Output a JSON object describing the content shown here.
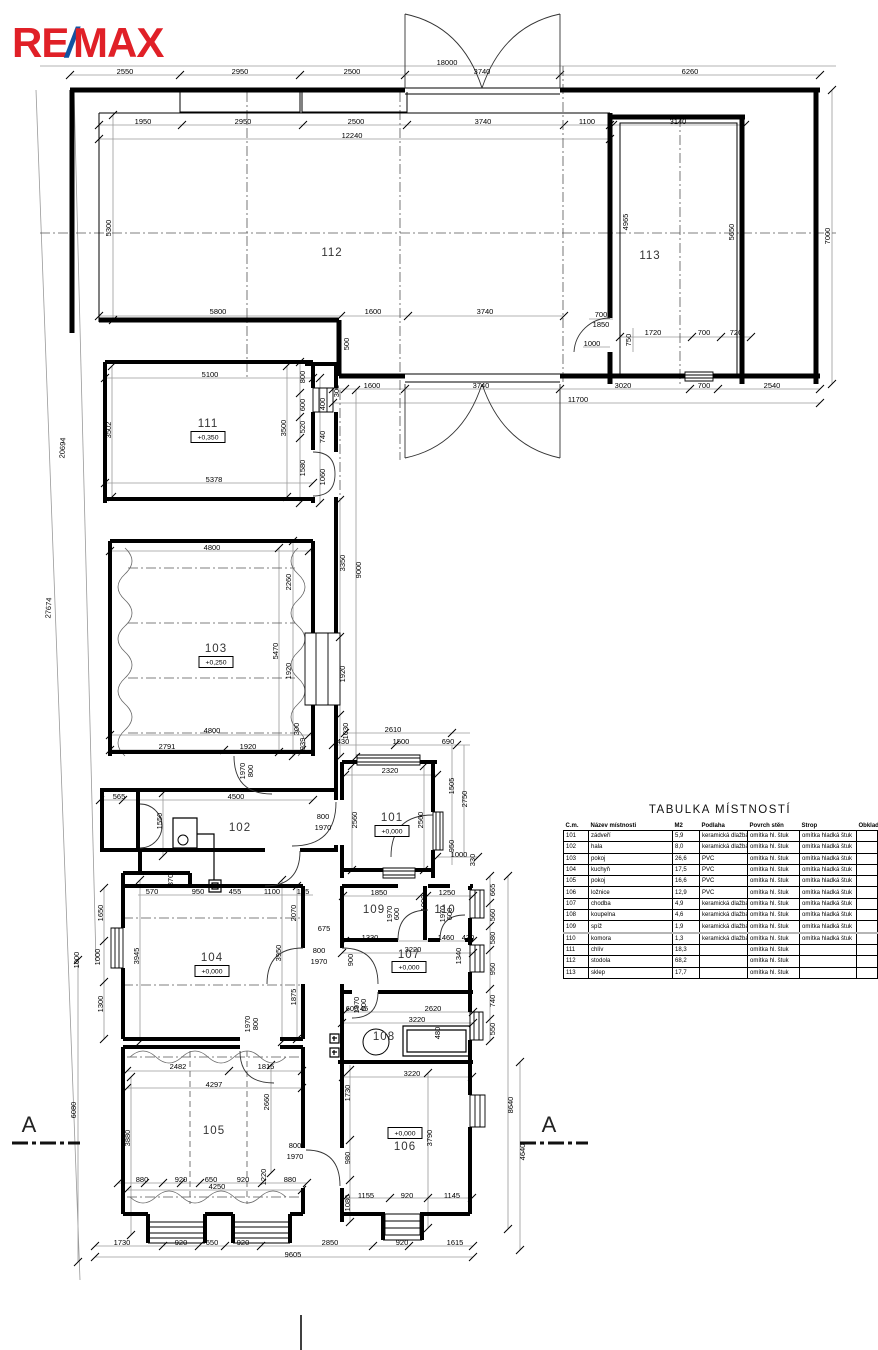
{
  "logo": {
    "re": "RE",
    "slash": "/",
    "max": "MAX",
    "red": "#E02027",
    "blue": "#1253A2"
  },
  "section_markers": {
    "left": "A",
    "right": "A"
  },
  "plan": {
    "rooms": [
      {
        "label": "112",
        "x": 332,
        "y": 253
      },
      {
        "label": "113",
        "x": 650,
        "y": 256
      },
      {
        "label": "111",
        "x": 208,
        "y": 424,
        "level": "+0,350",
        "lvx": 208,
        "lvy": 437
      },
      {
        "label": "103",
        "x": 216,
        "y": 649,
        "level": "+0,250",
        "lvx": 216,
        "lvy": 662
      },
      {
        "label": "102",
        "x": 240,
        "y": 828
      },
      {
        "label": "101",
        "x": 392,
        "y": 818,
        "level": "+0,000",
        "lvx": 392,
        "lvy": 831
      },
      {
        "label": "104",
        "x": 212,
        "y": 958,
        "level": "+0,000",
        "lvx": 212,
        "lvy": 971
      },
      {
        "label": "109",
        "x": 374,
        "y": 910
      },
      {
        "label": "110",
        "x": 445,
        "y": 910
      },
      {
        "label": "107",
        "x": 409,
        "y": 955,
        "level": "+0,000",
        "lvx": 409,
        "lvy": 967
      },
      {
        "label": "108",
        "x": 384,
        "y": 1037
      },
      {
        "label": "105",
        "x": 214,
        "y": 1131
      },
      {
        "label": "106",
        "x": 405,
        "y": 1147,
        "level": "+0,000",
        "lvx": 405,
        "lvy": 1133
      }
    ],
    "dims": [
      {
        "t": "2550",
        "x": 125,
        "y": 72
      },
      {
        "t": "2950",
        "x": 240,
        "y": 72
      },
      {
        "t": "2500",
        "x": 352,
        "y": 72
      },
      {
        "t": "3740",
        "x": 482,
        "y": 72
      },
      {
        "t": "6260",
        "x": 690,
        "y": 72
      },
      {
        "t": "18000",
        "x": 447,
        "y": 63
      },
      {
        "t": "1950",
        "x": 143,
        "y": 122
      },
      {
        "t": "2950",
        "x": 243,
        "y": 122
      },
      {
        "t": "2500",
        "x": 356,
        "y": 122
      },
      {
        "t": "3740",
        "x": 483,
        "y": 122
      },
      {
        "t": "1100",
        "x": 587,
        "y": 122
      },
      {
        "t": "12240",
        "x": 352,
        "y": 136
      },
      {
        "t": "3140",
        "x": 678,
        "y": 122
      },
      {
        "t": "5300",
        "x": 109,
        "y": 228,
        "r": 90
      },
      {
        "t": "4965",
        "x": 626,
        "y": 222,
        "r": 90
      },
      {
        "t": "5650",
        "x": 732,
        "y": 232,
        "r": 90
      },
      {
        "t": "7000",
        "x": 828,
        "y": 236,
        "r": 90
      },
      {
        "t": "5800",
        "x": 218,
        "y": 312
      },
      {
        "t": "1600",
        "x": 373,
        "y": 312
      },
      {
        "t": "3740",
        "x": 485,
        "y": 312
      },
      {
        "t": "500",
        "x": 347,
        "y": 344,
        "r": 90
      },
      {
        "t": "700",
        "x": 601,
        "y": 315
      },
      {
        "t": "1850",
        "x": 601,
        "y": 325
      },
      {
        "t": "1000",
        "x": 592,
        "y": 344
      },
      {
        "t": "750",
        "x": 629,
        "y": 340,
        "r": 90
      },
      {
        "t": "1720",
        "x": 653,
        "y": 333
      },
      {
        "t": "700",
        "x": 704,
        "y": 333
      },
      {
        "t": "720",
        "x": 736,
        "y": 333
      },
      {
        "t": "300",
        "x": 337,
        "y": 391,
        "r": 90
      },
      {
        "t": "1600",
        "x": 372,
        "y": 386
      },
      {
        "t": "3740",
        "x": 481,
        "y": 386
      },
      {
        "t": "3020",
        "x": 623,
        "y": 386
      },
      {
        "t": "700",
        "x": 704,
        "y": 386
      },
      {
        "t": "2540",
        "x": 772,
        "y": 386
      },
      {
        "t": "11700",
        "x": 578,
        "y": 400
      },
      {
        "t": "20694",
        "x": 63,
        "y": 448,
        "r": 87
      },
      {
        "t": "27674",
        "x": 49,
        "y": 608,
        "r": 87
      },
      {
        "t": "5100",
        "x": 210,
        "y": 375
      },
      {
        "t": "3502",
        "x": 109,
        "y": 430,
        "r": 90
      },
      {
        "t": "3500",
        "x": 284,
        "y": 428,
        "r": 90
      },
      {
        "t": "5378",
        "x": 214,
        "y": 480
      },
      {
        "t": "800",
        "x": 303,
        "y": 377,
        "r": 90
      },
      {
        "t": "600",
        "x": 303,
        "y": 405,
        "r": 90
      },
      {
        "t": "520",
        "x": 303,
        "y": 427,
        "r": 90
      },
      {
        "t": "1580",
        "x": 303,
        "y": 468,
        "r": 90
      },
      {
        "t": "400",
        "x": 323,
        "y": 404,
        "r": 90
      },
      {
        "t": "740",
        "x": 323,
        "y": 437,
        "r": 90
      },
      {
        "t": "1060",
        "x": 323,
        "y": 477,
        "r": 90
      },
      {
        "t": "3350",
        "x": 343,
        "y": 563,
        "r": 90
      },
      {
        "t": "9000",
        "x": 359,
        "y": 570,
        "r": 90
      },
      {
        "t": "1920",
        "x": 343,
        "y": 674,
        "r": 90
      },
      {
        "t": "1030",
        "x": 346,
        "y": 731,
        "r": 90
      },
      {
        "t": "4800",
        "x": 212,
        "y": 548
      },
      {
        "t": "2260",
        "x": 289,
        "y": 582,
        "r": 90
      },
      {
        "t": "5470",
        "x": 276,
        "y": 651,
        "r": 90
      },
      {
        "t": "1920",
        "x": 289,
        "y": 671,
        "r": 90
      },
      {
        "t": "4800",
        "x": 212,
        "y": 731
      },
      {
        "t": "2791",
        "x": 167,
        "y": 747
      },
      {
        "t": "1920",
        "x": 248,
        "y": 747
      },
      {
        "t": "939",
        "x": 303,
        "y": 744,
        "r": 90
      },
      {
        "t": "300",
        "x": 297,
        "y": 729,
        "r": 90
      },
      {
        "t": "1970",
        "x": 243,
        "y": 771,
        "r": 90
      },
      {
        "t": "800",
        "x": 251,
        "y": 771,
        "r": 90
      },
      {
        "t": "430",
        "x": 343,
        "y": 742
      },
      {
        "t": "2610",
        "x": 393,
        "y": 730
      },
      {
        "t": "1500",
        "x": 401,
        "y": 742
      },
      {
        "t": "690",
        "x": 448,
        "y": 742
      },
      {
        "t": "565",
        "x": 119,
        "y": 797
      },
      {
        "t": "4500",
        "x": 236,
        "y": 797
      },
      {
        "t": "1550",
        "x": 160,
        "y": 821,
        "r": 90
      },
      {
        "t": "800",
        "x": 323,
        "y": 817
      },
      {
        "t": "1970",
        "x": 323,
        "y": 828
      },
      {
        "t": "370",
        "x": 171,
        "y": 880,
        "r": 90
      },
      {
        "t": "570",
        "x": 152,
        "y": 892
      },
      {
        "t": "950",
        "x": 198,
        "y": 892
      },
      {
        "t": "455",
        "x": 235,
        "y": 892
      },
      {
        "t": "1100",
        "x": 272,
        "y": 892
      },
      {
        "t": "185",
        "x": 303,
        "y": 892
      },
      {
        "t": "2320",
        "x": 390,
        "y": 771
      },
      {
        "t": "2560",
        "x": 355,
        "y": 820,
        "r": 90
      },
      {
        "t": "2560",
        "x": 421,
        "y": 820,
        "r": 90
      },
      {
        "t": "1505",
        "x": 452,
        "y": 786,
        "r": 90
      },
      {
        "t": "2750",
        "x": 465,
        "y": 799,
        "r": 90
      },
      {
        "t": "950",
        "x": 452,
        "y": 846,
        "r": 90
      },
      {
        "t": "1000",
        "x": 459,
        "y": 855
      },
      {
        "t": "330",
        "x": 473,
        "y": 860,
        "r": 90
      },
      {
        "t": "1850",
        "x": 379,
        "y": 893
      },
      {
        "t": "1250",
        "x": 447,
        "y": 893
      },
      {
        "t": "1000",
        "x": 424,
        "y": 903,
        "r": 90
      },
      {
        "t": "1970",
        "x": 390,
        "y": 914,
        "r": 90
      },
      {
        "t": "600",
        "x": 397,
        "y": 914,
        "r": 90
      },
      {
        "t": "1970",
        "x": 443,
        "y": 914,
        "r": 90
      },
      {
        "t": "600",
        "x": 450,
        "y": 914,
        "r": 90
      },
      {
        "t": "675",
        "x": 324,
        "y": 929
      },
      {
        "t": "1330",
        "x": 370,
        "y": 938
      },
      {
        "t": "1460",
        "x": 446,
        "y": 938
      },
      {
        "t": "430",
        "x": 468,
        "y": 938
      },
      {
        "t": "3220",
        "x": 413,
        "y": 950
      },
      {
        "t": "1340",
        "x": 459,
        "y": 956,
        "r": 90
      },
      {
        "t": "900",
        "x": 351,
        "y": 960,
        "r": 90
      },
      {
        "t": "800",
        "x": 319,
        "y": 951
      },
      {
        "t": "1970",
        "x": 319,
        "y": 962
      },
      {
        "t": "600",
        "x": 352,
        "y": 1009
      },
      {
        "t": "45",
        "x": 364,
        "y": 1009
      },
      {
        "t": "2620",
        "x": 433,
        "y": 1009
      },
      {
        "t": "3220",
        "x": 417,
        "y": 1020
      },
      {
        "t": "480",
        "x": 438,
        "y": 1033,
        "r": 90
      },
      {
        "t": "1970",
        "x": 357,
        "y": 1005,
        "r": 90
      },
      {
        "t": "600",
        "x": 364,
        "y": 1005,
        "r": 90
      },
      {
        "t": "1650",
        "x": 101,
        "y": 913,
        "r": 90
      },
      {
        "t": "1000",
        "x": 98,
        "y": 957,
        "r": 90
      },
      {
        "t": "3945",
        "x": 137,
        "y": 956,
        "r": 90
      },
      {
        "t": "1300",
        "x": 101,
        "y": 1004,
        "r": 90
      },
      {
        "t": "2070",
        "x": 294,
        "y": 913,
        "r": 90
      },
      {
        "t": "3950",
        "x": 279,
        "y": 953,
        "r": 90
      },
      {
        "t": "1875",
        "x": 294,
        "y": 997,
        "r": 90
      },
      {
        "t": "1970",
        "x": 248,
        "y": 1024,
        "r": 90
      },
      {
        "t": "800",
        "x": 256,
        "y": 1024,
        "r": 90
      },
      {
        "t": "2482",
        "x": 178,
        "y": 1067
      },
      {
        "t": "1815",
        "x": 266,
        "y": 1067
      },
      {
        "t": "4297",
        "x": 214,
        "y": 1085
      },
      {
        "t": "3880",
        "x": 128,
        "y": 1138,
        "r": 90
      },
      {
        "t": "2660",
        "x": 267,
        "y": 1102,
        "r": 90
      },
      {
        "t": "800",
        "x": 295,
        "y": 1146
      },
      {
        "t": "1970",
        "x": 295,
        "y": 1157
      },
      {
        "t": "4250",
        "x": 217,
        "y": 1187
      },
      {
        "t": "880",
        "x": 142,
        "y": 1180
      },
      {
        "t": "920",
        "x": 181,
        "y": 1180
      },
      {
        "t": "650",
        "x": 211,
        "y": 1180
      },
      {
        "t": "920",
        "x": 243,
        "y": 1180
      },
      {
        "t": "1220",
        "x": 264,
        "y": 1177,
        "r": 90
      },
      {
        "t": "880",
        "x": 290,
        "y": 1180
      },
      {
        "t": "3220",
        "x": 412,
        "y": 1074
      },
      {
        "t": "1730",
        "x": 348,
        "y": 1093,
        "r": 90
      },
      {
        "t": "980",
        "x": 348,
        "y": 1158,
        "r": 90
      },
      {
        "t": "1080",
        "x": 348,
        "y": 1203,
        "r": 90
      },
      {
        "t": "3790",
        "x": 430,
        "y": 1138,
        "r": 90
      },
      {
        "t": "1155",
        "x": 366,
        "y": 1196
      },
      {
        "t": "920",
        "x": 407,
        "y": 1196
      },
      {
        "t": "1145",
        "x": 452,
        "y": 1196
      },
      {
        "t": "665",
        "x": 493,
        "y": 890,
        "r": 90
      },
      {
        "t": "560",
        "x": 493,
        "y": 915,
        "r": 90
      },
      {
        "t": "580",
        "x": 493,
        "y": 938,
        "r": 90
      },
      {
        "t": "950",
        "x": 493,
        "y": 969,
        "r": 90
      },
      {
        "t": "740",
        "x": 493,
        "y": 1001,
        "r": 90
      },
      {
        "t": "550",
        "x": 493,
        "y": 1029,
        "r": 90
      },
      {
        "t": "8640",
        "x": 511,
        "y": 1105,
        "r": 90
      },
      {
        "t": "4640",
        "x": 523,
        "y": 1152,
        "r": 90
      },
      {
        "t": "6080",
        "x": 74,
        "y": 1110,
        "r": 90
      },
      {
        "t": "1000",
        "x": 77,
        "y": 960,
        "r": 90
      },
      {
        "t": "1730",
        "x": 122,
        "y": 1243
      },
      {
        "t": "920",
        "x": 181,
        "y": 1243
      },
      {
        "t": "650",
        "x": 212,
        "y": 1243
      },
      {
        "t": "920",
        "x": 243,
        "y": 1243
      },
      {
        "t": "2850",
        "x": 330,
        "y": 1243
      },
      {
        "t": "920",
        "x": 402,
        "y": 1243
      },
      {
        "t": "1615",
        "x": 455,
        "y": 1243
      },
      {
        "t": "9605",
        "x": 293,
        "y": 1255
      }
    ]
  },
  "table": {
    "title": "TABULKA MÍSTNOSTÍ",
    "headers": [
      "Č.m.",
      "Název místnosti",
      "M2",
      "Podlaha",
      "Povrch stěn",
      "Strop",
      "Obklad"
    ],
    "rows": [
      [
        "101",
        "zádveří",
        "5,9",
        "keramická dlažba",
        "omítka hl. štuk",
        "omítka hladká štuk",
        ""
      ],
      [
        "102",
        "hala",
        "8,0",
        "keramická dlažba",
        "omítka hl. štuk",
        "omítka hladká štuk",
        ""
      ],
      [
        "103",
        "pokoj",
        "26,6",
        "PVC",
        "omítka hl. štuk",
        "omítka hladká štuk",
        ""
      ],
      [
        "104",
        "kuchyň",
        "17,5",
        "PVC",
        "omítka hl. štuk",
        "omítka hladká štuk",
        ""
      ],
      [
        "105",
        "pokoj",
        "16,6",
        "PVC",
        "omítka hl. štuk",
        "omítka hladká štuk",
        ""
      ],
      [
        "106",
        "ložnice",
        "12,9",
        "PVC",
        "omítka hl. štuk",
        "omítka hladká štuk",
        ""
      ],
      [
        "107",
        "chodba",
        "4,9",
        "keramická dlažba",
        "omítka hl. štuk",
        "omítka hladká štuk",
        ""
      ],
      [
        "108",
        "koupelna",
        "4,6",
        "keramická dlažba",
        "omítka hl. štuk",
        "omítka hladká štuk",
        ""
      ],
      [
        "109",
        "spíž",
        "1,9",
        "keramická dlažba",
        "omítka hl. štuk",
        "omítka hladká štuk",
        ""
      ],
      [
        "110",
        "komora",
        "1,3",
        "keramická dlažba",
        "omítka hl. štuk",
        "omítka hladká štuk",
        ""
      ],
      [
        "111",
        "chlív",
        "18,3",
        "",
        "omítka hl. štuk",
        "",
        ""
      ],
      [
        "112",
        "stodola",
        "68,2",
        "",
        "omítka hl. štuk",
        "",
        ""
      ],
      [
        "113",
        "sklep",
        "17,7",
        "",
        "omítka hl. štuk",
        "",
        ""
      ]
    ]
  }
}
